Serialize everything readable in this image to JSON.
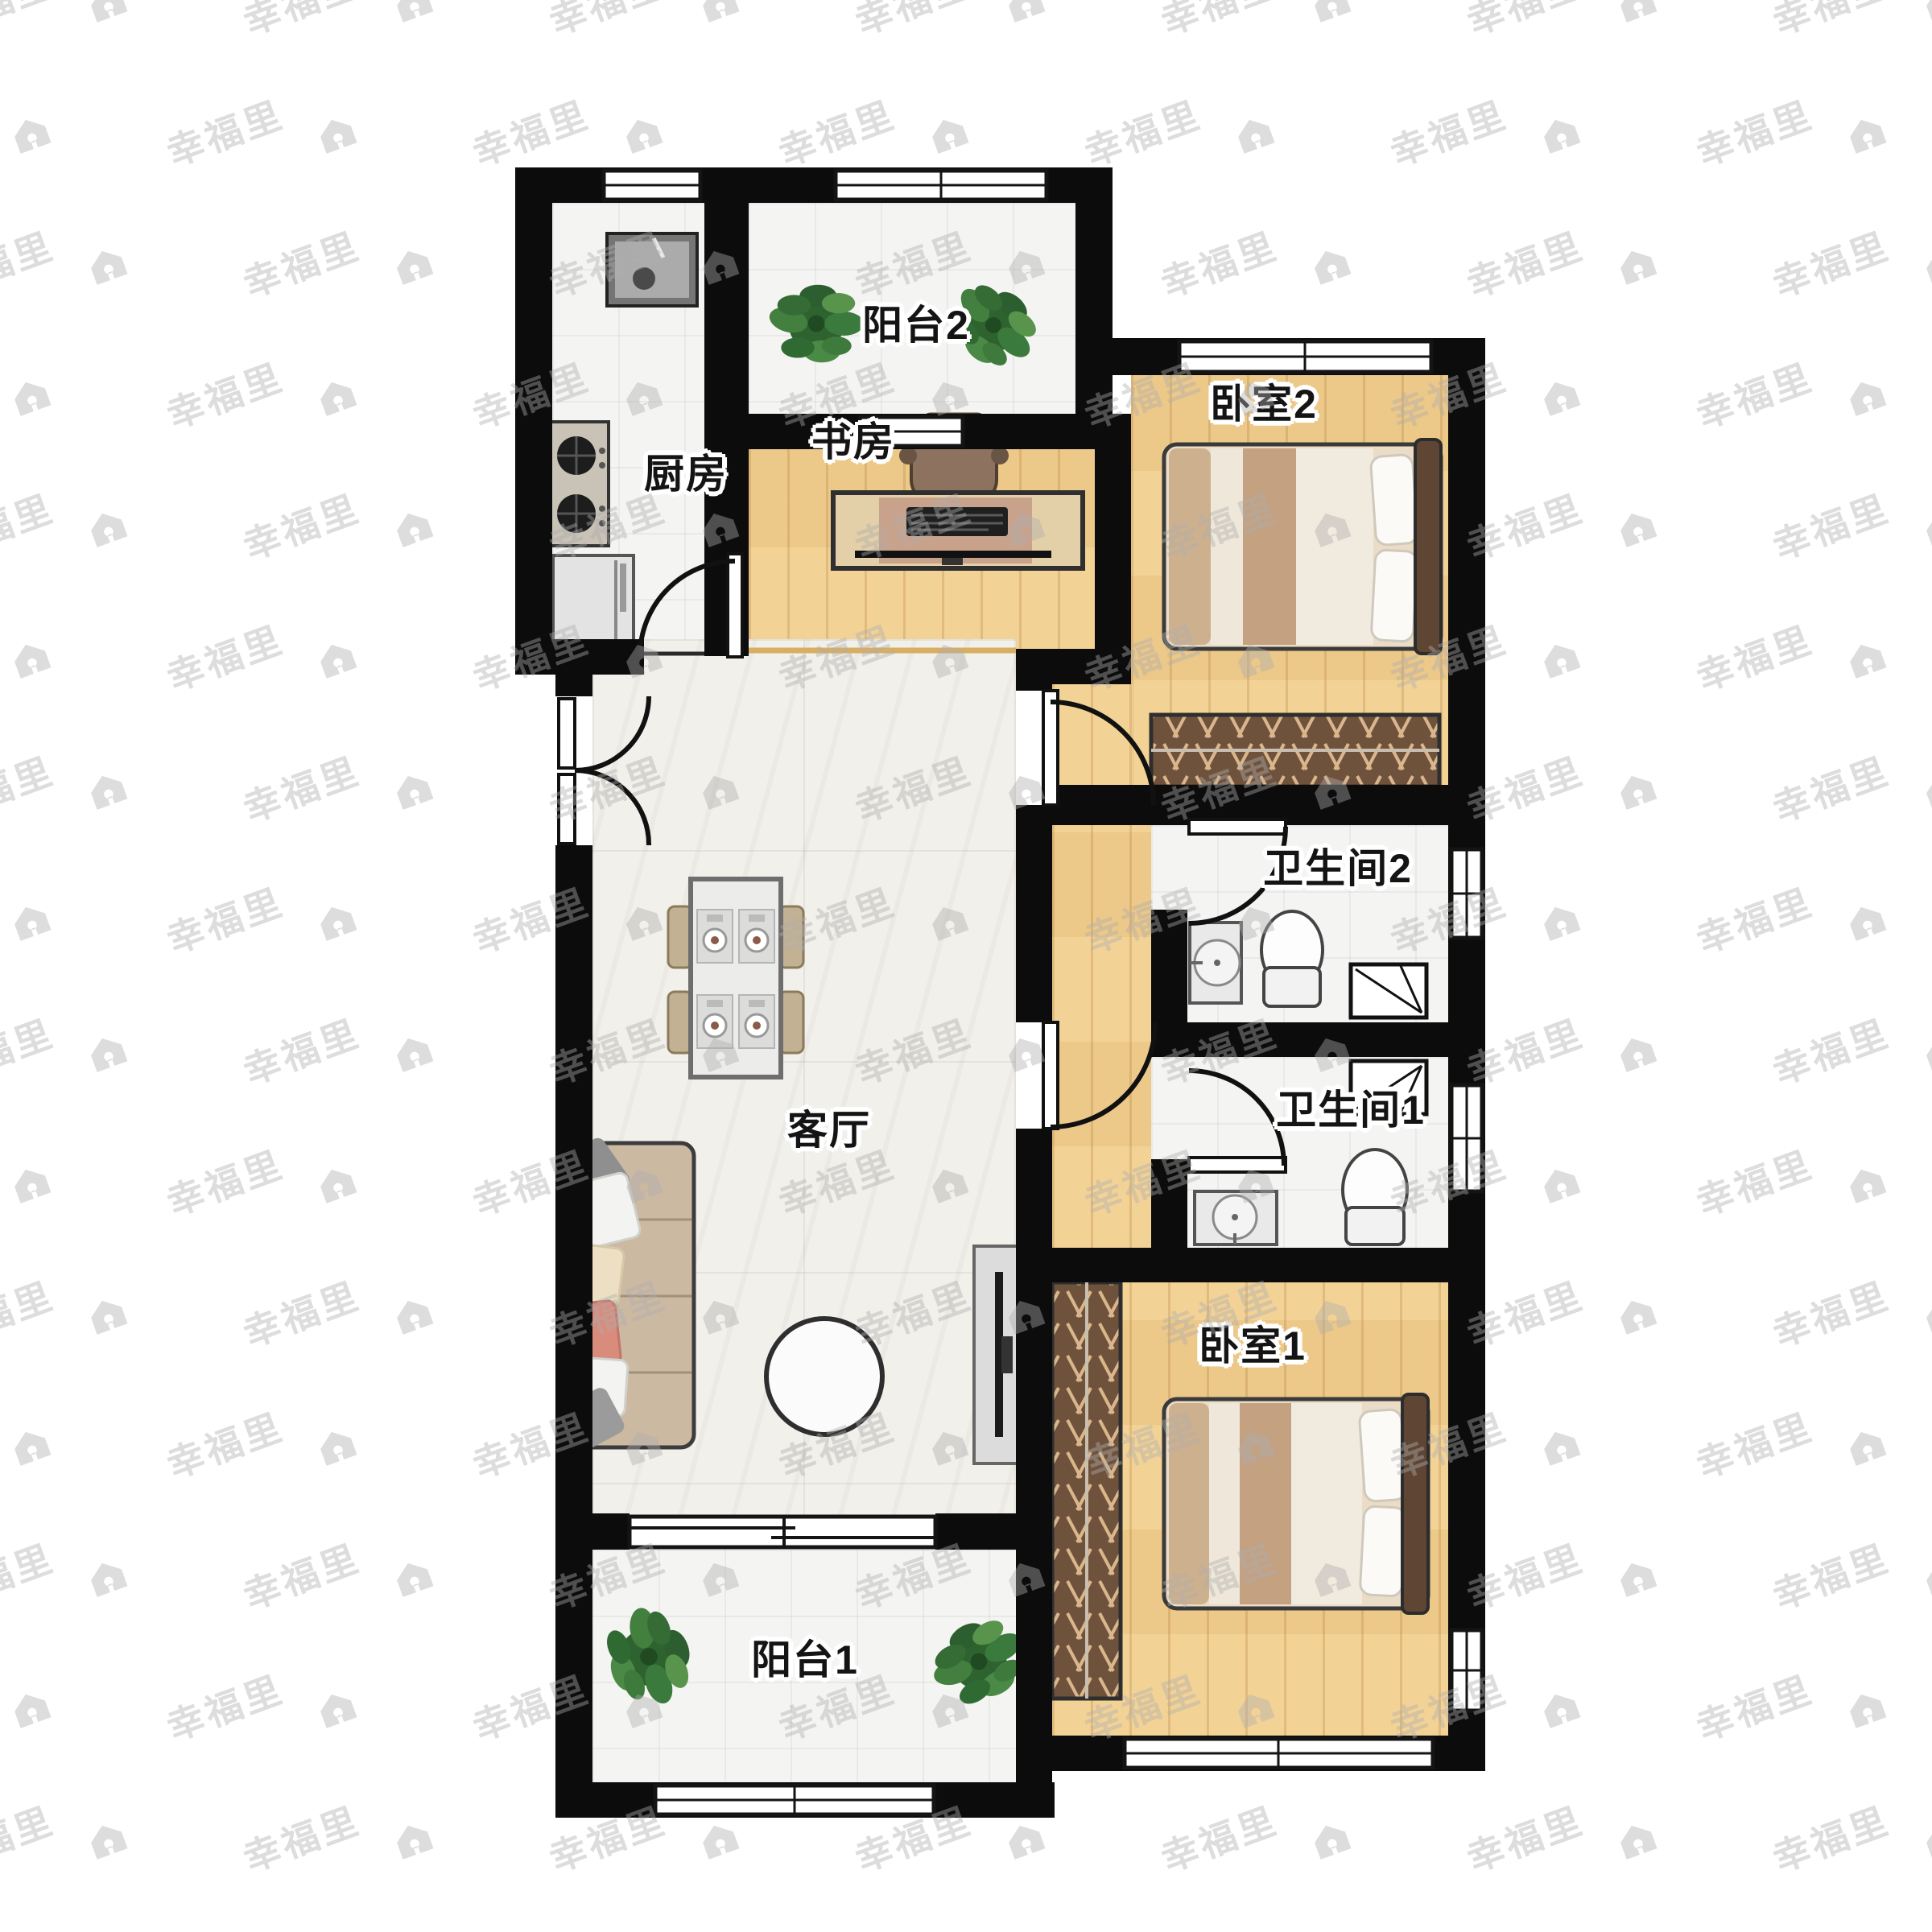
{
  "title": "apartment-floor-plan",
  "watermark": {
    "brand_text": "幸福里",
    "icon": "house-icon"
  },
  "rooms": [
    {
      "id": "kitchen",
      "label": "厨房"
    },
    {
      "id": "balcony-2",
      "label": "阳台2"
    },
    {
      "id": "study",
      "label": "书房"
    },
    {
      "id": "bedroom-2",
      "label": "卧室2"
    },
    {
      "id": "living-room",
      "label": "客厅"
    },
    {
      "id": "bathroom-2",
      "label": "卫生间2"
    },
    {
      "id": "bathroom-1",
      "label": "卫生间1"
    },
    {
      "id": "bedroom-1",
      "label": "卧室1"
    },
    {
      "id": "balcony-1",
      "label": "阳台1"
    }
  ],
  "furniture": [
    "kitchen-sink",
    "gas-stove",
    "fridge",
    "dining-table",
    "dining-chairs",
    "place-settings",
    "sofa",
    "coffee-table",
    "tv-cabinet",
    "tv",
    "desk",
    "desk-chair",
    "keyboard",
    "monitor",
    "double-bed-2",
    "wardrobe-2",
    "double-bed-1",
    "wardrobe-1",
    "toilet-2",
    "washbasin-2",
    "vent-shaft-2",
    "toilet-1",
    "washbasin-1",
    "vent-shaft-1",
    "potted-plants",
    "entry-double-door",
    "swing-doors",
    "sliding-balcony-door",
    "windows"
  ],
  "palette": {
    "wall": "#0c0c0c",
    "wood_floor": "#f2cf90",
    "tile_floor": "#f4f4f3",
    "marble_floor": "#f2f0eb",
    "wardrobe_wood": "#6f523c",
    "bed_tan": "#c3a181",
    "plant_green": "#3a7a3c",
    "watermark_gray": "#dddddd"
  }
}
